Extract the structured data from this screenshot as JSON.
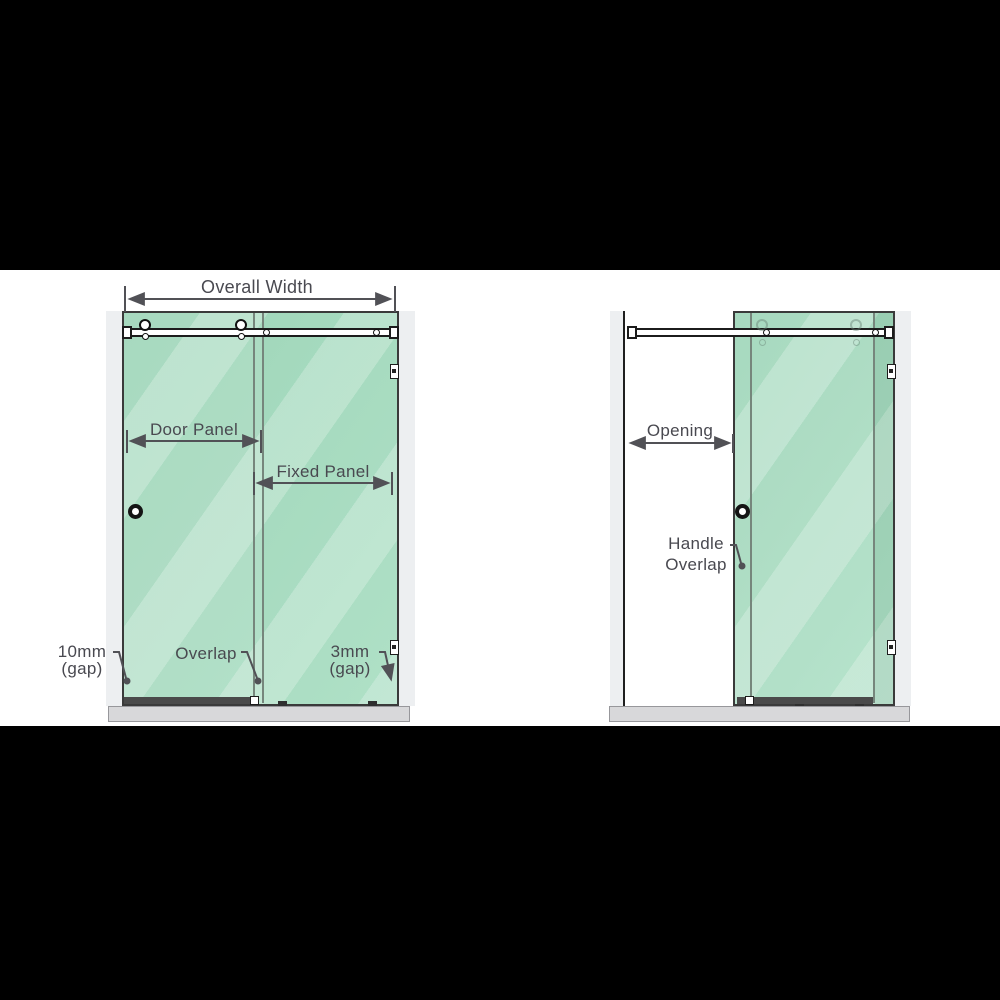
{
  "title": "Sliding shower screen measurement diagram",
  "colors": {
    "glass_green": "#a6ddc0",
    "glass_streak": "#c6ecd8",
    "frame_outline": "#3a3a3a",
    "label_text": "#494950",
    "dimension_line": "#515156",
    "wall_strip": "#edeff1",
    "floor_tray": "#d8d8da",
    "letterbox": "#000000"
  },
  "diagram_closed": {
    "name": "closed configuration",
    "overall_width_label": "Overall Width",
    "door_panel_label": "Door Panel",
    "fixed_panel_label": "Fixed Panel",
    "gap_left": {
      "line1": "10mm",
      "line2": "(gap)"
    },
    "overlap_label": "Overlap",
    "gap_right": {
      "line1": "3mm",
      "line2": "(gap)"
    }
  },
  "diagram_open": {
    "name": "open configuration",
    "opening_label": "Opening",
    "handle_overlap": {
      "line1": "Handle",
      "line2": "Overlap"
    }
  }
}
